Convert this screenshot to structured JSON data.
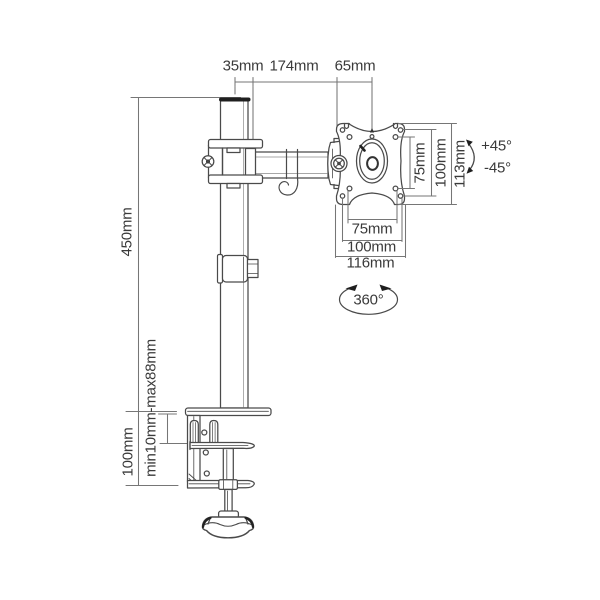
{
  "colors": {
    "line": "#4a4a4a",
    "dim_line": "#767676",
    "text": "#3a3a3a",
    "accent_dark": "#1f1f1f",
    "background": "#ffffff"
  },
  "labels": {
    "pole_diameter": "35mm",
    "arm_length": "174mm",
    "vesa_offset": "65mm",
    "pole_height": "450mm",
    "clamp_height": "100mm",
    "desk_thickness_range": "min10mm-max88mm",
    "vesa_vertical_inner": "75mm",
    "vesa_vertical_outer": "100mm",
    "vesa_vertical_total": "113mm",
    "vesa_horizontal_inner": "75mm",
    "vesa_horizontal_outer": "100mm",
    "vesa_horizontal_total": "116mm",
    "tilt_up": "+45°",
    "tilt_down": "-45°",
    "swivel": "360°"
  }
}
